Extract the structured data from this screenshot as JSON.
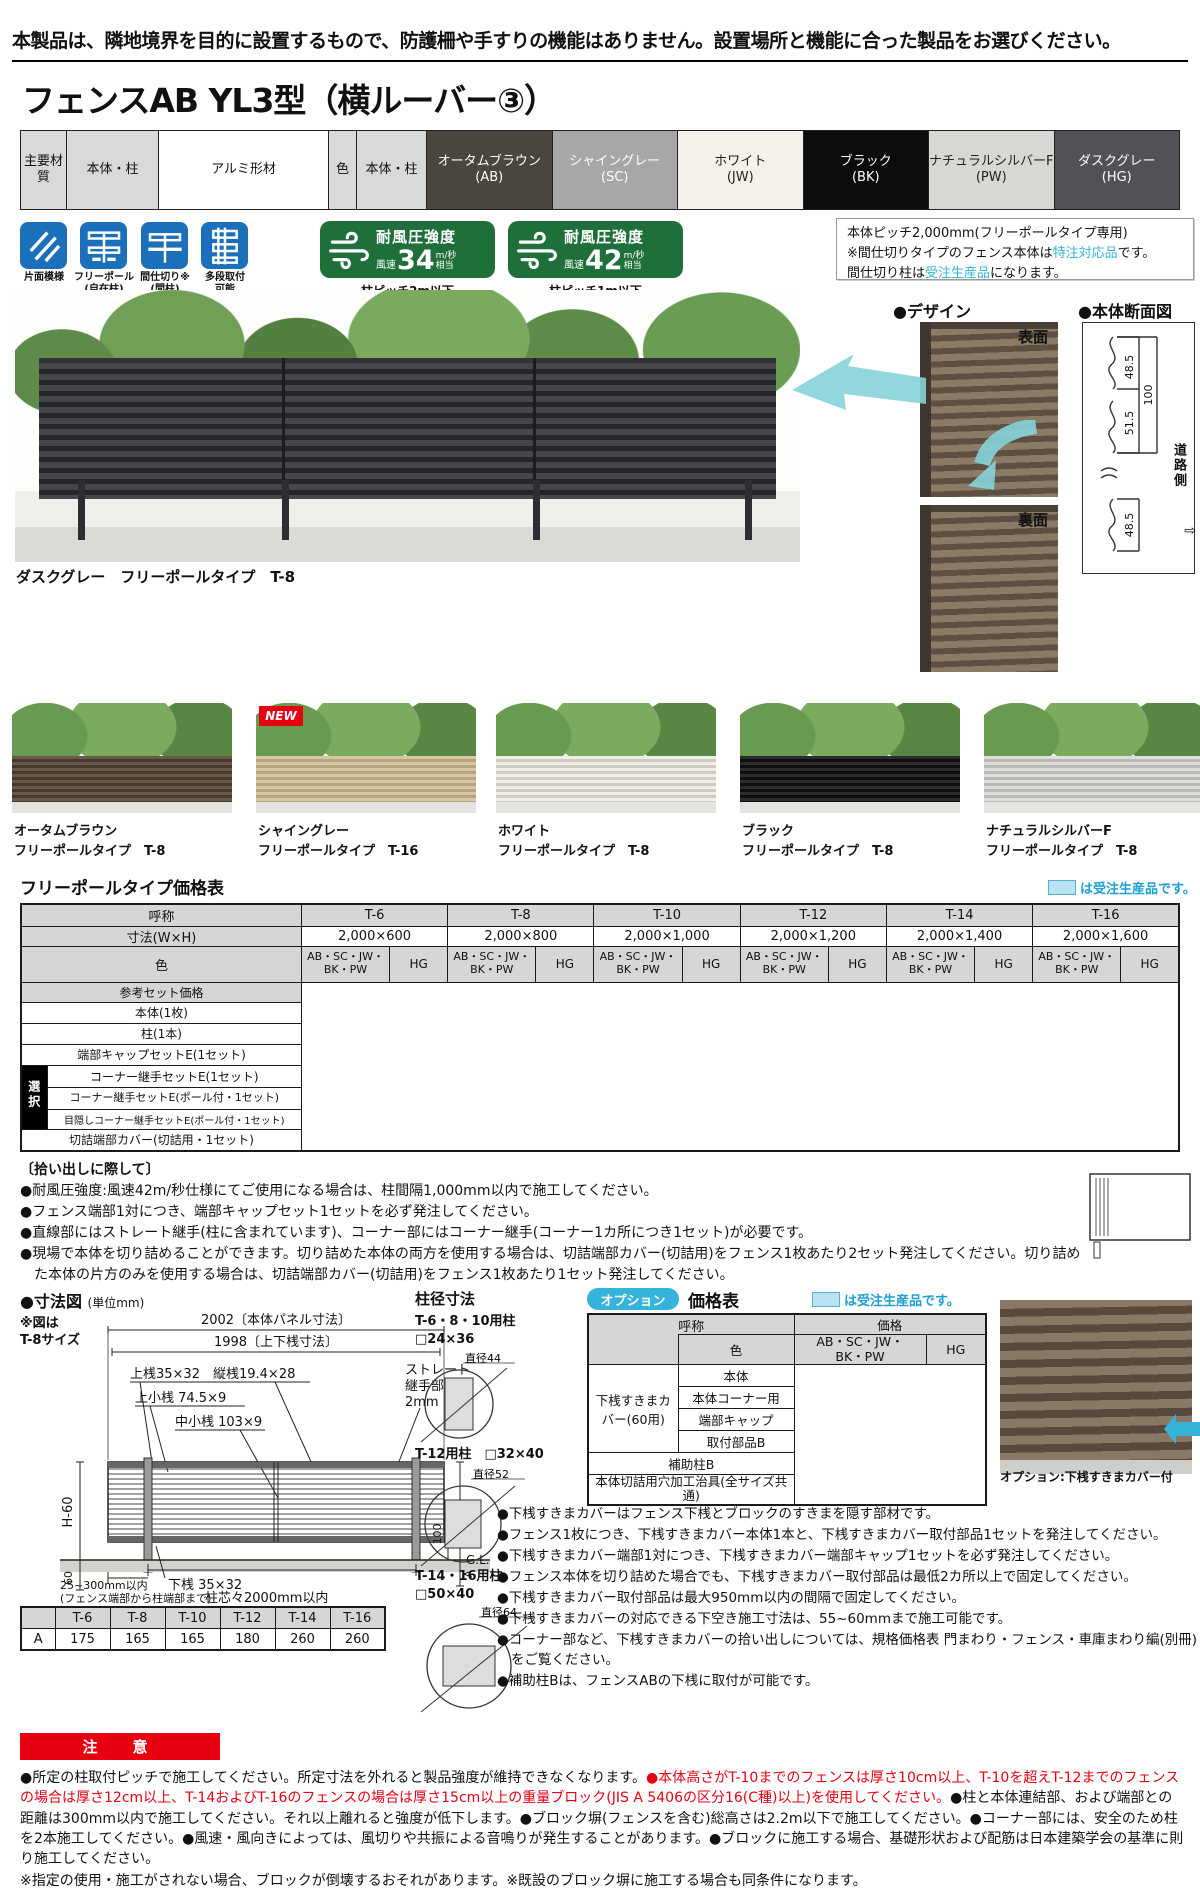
{
  "legend_text": "は受注生産品です。",
  "notice": "本製品は、隣地境界を目的に設置するもので、防護柵や手すりの機能はありません。設置場所と機能に合った製品をお選びください。",
  "title": "フェンスAB YL3型（横ルーバー③）",
  "materials": {
    "head1": "主要材質",
    "head2": "本体・柱",
    "value1": "アルミ形材",
    "head3": "色",
    "head4": "本体・柱",
    "colors": [
      {
        "name": "オータムブラウン",
        "code": "(AB)",
        "bg": "#4a463f",
        "fg": "#ffffff"
      },
      {
        "name": "シャイングレー",
        "code": "(SC)",
        "bg": "#a7a7a8",
        "fg": "#ffffff"
      },
      {
        "name": "ホワイト",
        "code": "(JW)",
        "bg": "#f3f1ea",
        "fg": "#222222"
      },
      {
        "name": "ブラック",
        "code": "(BK)",
        "bg": "#0c0c0c",
        "fg": "#ffffff"
      },
      {
        "name": "ナチュラルシルバーF",
        "code": "(PW)",
        "bg": "#d7d7d3",
        "fg": "#222222"
      },
      {
        "name": "ダスクグレー",
        "code": "(HG)",
        "bg": "#515257",
        "fg": "#ffffff"
      }
    ]
  },
  "features": [
    {
      "label": "片面模様",
      "sub": ""
    },
    {
      "label": "フリーポール",
      "sub": "(自在柱)"
    },
    {
      "label": "間仕切り※",
      "sub": "(間柱)"
    },
    {
      "label": "多段取付",
      "sub": "可能"
    }
  ],
  "wind_badges": [
    {
      "title": "耐風圧強度",
      "prefix": "風速",
      "value": "34",
      "unit": "m/秒",
      "unit2": "相当",
      "note": "柱ピッチ2m以下"
    },
    {
      "title": "耐風圧強度",
      "prefix": "風速",
      "value": "42",
      "unit": "m/秒",
      "unit2": "相当",
      "note": "柱ピッチ1m以下"
    }
  ],
  "info_box": {
    "line1": "本体ピッチ2,000mm(フリーポールタイプ専用)",
    "line2_pre": "※間仕切りタイプのフェンス本体は",
    "line2_hl": "特注対応品",
    "line2_post": "です。",
    "line3_pre": "間仕切り柱は",
    "line3_hl": "受注生産品",
    "line3_post": "になります。"
  },
  "photo_caption": "ダスクグレー　フリーポールタイプ　T-8",
  "design": {
    "title": "●デザイン",
    "front": "表面",
    "back": "裏面"
  },
  "section_view": {
    "title": "●本体断面図",
    "d1": "48.5",
    "d2": "100",
    "d3": "51.5",
    "d4": "48.5",
    "road": "道路側",
    "arrow": "⇨"
  },
  "variants": [
    {
      "name": "オータムブラウン",
      "type": "フリーポールタイプ　T-8"
    },
    {
      "name": "シャイングレー",
      "type": "フリーポールタイプ　T-16"
    },
    {
      "name": "ホワイト",
      "type": "フリーポールタイプ　T-8"
    },
    {
      "name": "ブラック",
      "type": "フリーポールタイプ　T-8"
    },
    {
      "name": "ナチュラルシルバーF",
      "type": "フリーポールタイプ　T-8"
    }
  ],
  "new_badge": "NEW",
  "price_table": {
    "title": "フリーポールタイプ価格表",
    "col_header": "呼称",
    "sizes": [
      "T-6",
      "T-8",
      "T-10",
      "T-12",
      "T-14",
      "T-16"
    ],
    "dim_label": "寸法(W×H)",
    "dims": [
      "2,000×600",
      "2,000×800",
      "2,000×1,000",
      "2,000×1,200",
      "2,000×1,400",
      "2,000×1,600"
    ],
    "color_label": "色",
    "cg1_l1": "AB・SC・JW・",
    "cg1_l2": "BK・PW",
    "cg2": "HG",
    "set_price_label": "参考セット価格",
    "rows": [
      "本体(1枚)",
      "柱(1本)",
      "端部キャップセットE(1セット)"
    ],
    "select_label": "選択",
    "select_rows": [
      "コーナー継手セットE(1セット)",
      "コーナー継手セットE(ポール付・1セット)",
      "目隠しコーナー継手セットE(ポール付・1セット)"
    ],
    "last_row": "切詰端部カバー(切詰用・1セット)"
  },
  "pickup_notes": {
    "title": "〔拾い出しに際して〕",
    "items": [
      "●耐風圧強度:風速42m/秒仕様にてご使用になる場合は、柱間隔1,000mm以内で施工してください。",
      "●フェンス端部1対につき、端部キャップセット1セットを必ず発注してください。",
      "●直線部にはストレート継手(柱に含まれています)、コーナー部にはコーナー継手(コーナー1カ所につき1セット)が必要です。",
      "●現場で本体を切り詰めることができます。切り詰めた本体の両方を使用する場合は、切詰端部カバー(切詰用)をフェンス1枚あたり2セット発注してください。切り詰めた本体の片方のみを使用する場合は、切詰端部カバー(切詰用)をフェンス1枚あたり1セット発注してください。"
    ]
  },
  "dim_diagram": {
    "title": "●寸法図",
    "unit": "(単位mm)",
    "note1": "※図は",
    "note2": "T-8サイズ",
    "panel": "2002〔本体パネル寸法〕",
    "rail": "1998〔上下桟寸法〕",
    "toprail": "上桟35×32　縦桟19.4×28",
    "topsub": "上小桟 74.5×9",
    "midsub": "中小桟 103×9",
    "joint1": "ストレート",
    "joint2": "継手部",
    "joint3": "2mm",
    "h60": "H-60",
    "h": "H",
    "d100": "100",
    "gl": "G.L.",
    "d60": "60",
    "bottomrail": "下桟 35×32",
    "pitch": "柱芯々2000mm以内",
    "edge1": "25~300mm以内",
    "edge2": "(フェンス端部から柱端部まで)",
    "a": "A"
  },
  "a_table": {
    "row_label": "A",
    "values": [
      "175",
      "165",
      "165",
      "180",
      "260",
      "260"
    ]
  },
  "post_sizes": {
    "title": "柱径寸法",
    "items": [
      {
        "label": "T-6・8・10用柱",
        "size": "□24×36",
        "dia": "直径44"
      },
      {
        "label": "T-12用柱",
        "size": "□32×40",
        "dia": "直径52"
      },
      {
        "label": "T-14・16用柱",
        "size": "□50×40",
        "dia": "直径64"
      }
    ]
  },
  "option_table": {
    "badge": "オプション",
    "title": "価格表",
    "name_header": "呼称",
    "color_header": "色",
    "price_header": "価格",
    "cg1_l1": "AB・SC・JW・",
    "cg1_l2": "BK・PW",
    "cg2": "HG",
    "group_label": "下桟すきまカバー(60用)",
    "rows": [
      "本体",
      "本体コーナー用",
      "端部キャップ",
      "取付部品B"
    ],
    "aux_row": "補助柱B",
    "jig_row": "本体切詰用穴加工治具(全サイズ共通)"
  },
  "option_photo_caption": "オプション:下桟すきまカバー付",
  "option_notes": [
    "●下桟すきまカバーはフェンス下桟とブロックのすきまを隠す部材です。",
    "●フェンス1枚につき、下桟すきまカバー本体1本と、下桟すきまカバー取付部品1セットを発注してください。",
    "●下桟すきまカバー端部1対につき、下桟すきまカバー端部キャップ1セットを必ず発注してください。",
    "●フェンス本体を切り詰めた場合でも、下桟すきまカバー取付部品は最低2カ所以上で固定してください。",
    "●下桟すきまカバー取付部品は最大950mm以内の間隔で固定してください。",
    "●下桟すきまカバーの対応できる下空き施工寸法は、55~60mmまで施工可能です。",
    "●コーナー部など、下桟すきまカバーの拾い出しについては、規格価格表 門まわり・フェンス・車庫まわり編(別冊)をご覧ください。",
    "●補助柱Bは、フェンスABの下桟に取付が可能です。"
  ],
  "caution": {
    "title": "注　意",
    "seg1": "●所定の柱取付ピッチで施工してください。所定寸法を外れると製品強度が維持できなくなります。",
    "seg2": "●本体高さがT-10までのフェンスは厚さ10cm以上、T-10を超えT-12までのフェンスの場合は厚さ12cm以上、T-14およびT-16のフェンスの場合は厚さ15cm以上の重量ブロック(JIS A 5406の区分16(C種)以上)を使用してください。",
    "seg3": "●柱と本体連結部、および端部との距離は300mm以内で施工してください。それ以上離れると強度が低下します。●ブロック塀(フェンスを含む)総高さは2.2m以下で施工してください。●コーナー部には、安全のため柱を2本施工してください。●風速・風向きによっては、風切りや共振による音鳴りが発生することがあります。●ブロックに施工する場合、基礎形状および配筋は日本建築学会の基準に則り施工してください。",
    "note": "※指定の使用・施工がされない場合、ブロックが倒壊するおそれがあります。※既設のブロック塀に施工する場合も同条件になります。"
  }
}
